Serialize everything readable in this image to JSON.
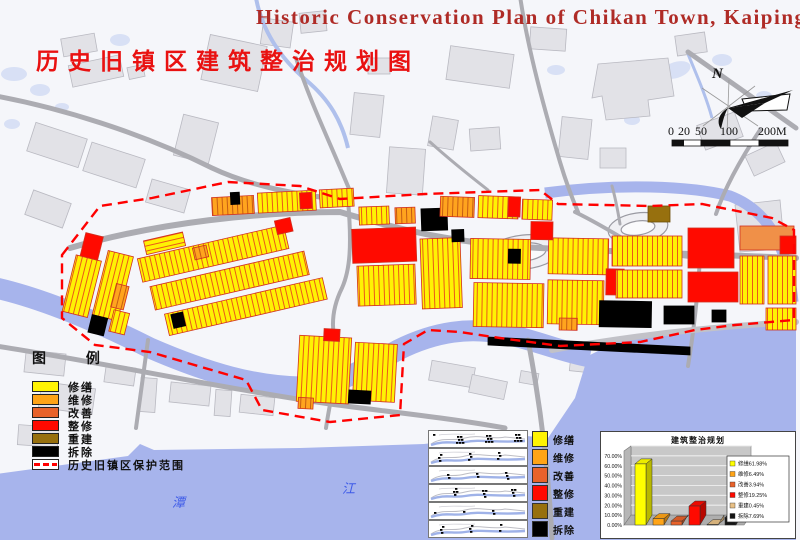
{
  "titles": {
    "en": "Historic Conservation Plan of Chikan Town, Kaiping",
    "zh": "历史旧镇区建筑整治规划图"
  },
  "compass": {
    "label": "N"
  },
  "scale_bar": {
    "ticks": [
      "0",
      "20",
      "50",
      "100",
      "200M"
    ]
  },
  "legend": {
    "header": "图  例",
    "items": [
      {
        "label": "修缮",
        "color": "#FFF303"
      },
      {
        "label": "维修",
        "color": "#FFA417"
      },
      {
        "label": "改善",
        "color": "#E8622A"
      },
      {
        "label": "整修",
        "color": "#FF0A00"
      },
      {
        "label": "重建",
        "color": "#97700E"
      },
      {
        "label": "拆除",
        "color": "#000000"
      }
    ],
    "boundary_label": "历史旧镇区保护范围",
    "boundary_color": "#FF0000"
  },
  "river_labels": {
    "tan": "潭",
    "jiang": "江"
  },
  "inset_panels": {
    "labels": [
      "修缮",
      "维修",
      "改善",
      "整修",
      "重建",
      "拆除"
    ]
  },
  "chart_data": {
    "type": "bar",
    "title": "建筑整治规划",
    "categories": [
      "修缮",
      "维修",
      "改善",
      "整修",
      "重建",
      "拆除"
    ],
    "values": [
      61.98,
      6.49,
      3.94,
      19.25,
      0.45,
      7.69
    ],
    "unit": "%",
    "colors": [
      "#FFFF00",
      "#FFA417",
      "#E8622A",
      "#FF0A00",
      "#E8C086",
      "#141414"
    ],
    "legend_labels": [
      "修缮61.98%",
      "维修6.49%",
      "改善3.94%",
      "整修19.25%",
      "重建0.45%",
      "拆除7.69%"
    ],
    "ylim": [
      0,
      70
    ],
    "yticks": [
      "70.00%",
      "60.00%",
      "50.00%",
      "40.00%",
      "30.00%",
      "20.00%",
      "10.00%",
      "0.00%"
    ],
    "grid": true,
    "legend_position": "right",
    "wall_color": "#C8C8C8"
  }
}
